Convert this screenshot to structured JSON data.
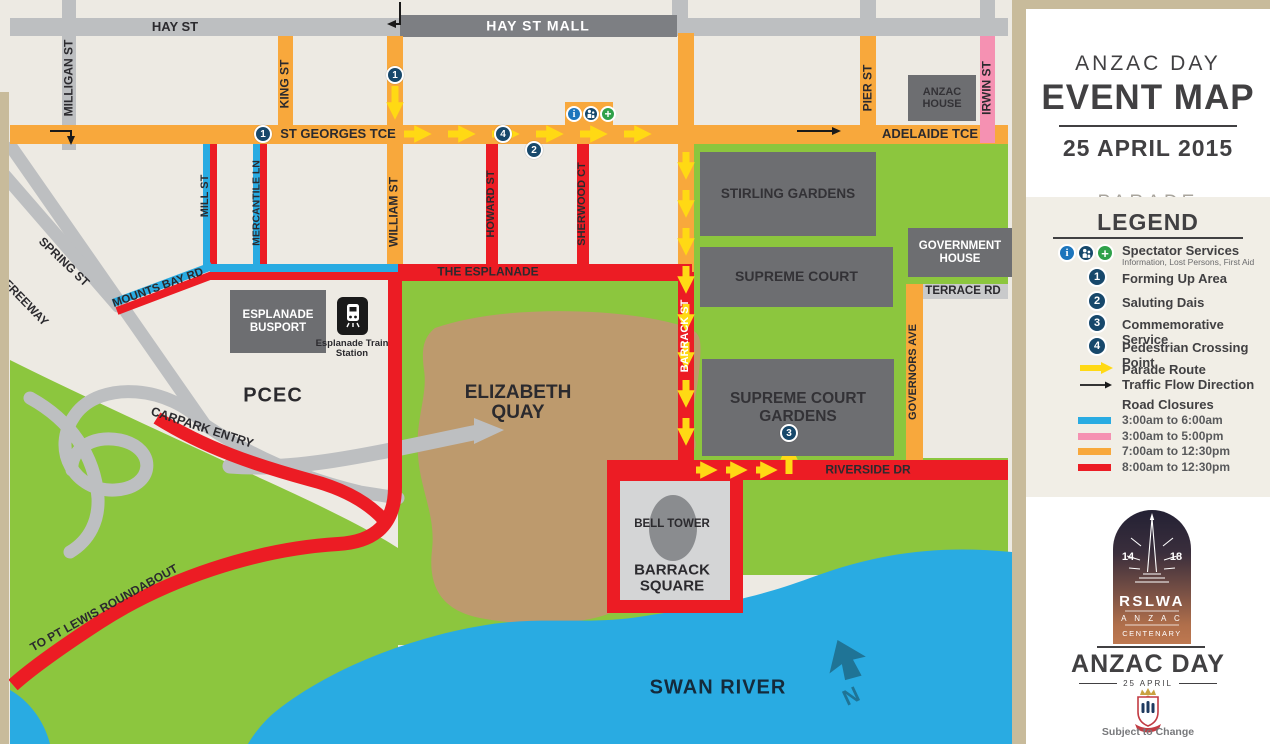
{
  "sidebar": {
    "title_line1": "ANZAC DAY",
    "title_line2": "EVENT MAP",
    "date": "25 APRIL 2015",
    "event": "PARADE",
    "start_time": "Start time: 9:30am",
    "location": "PERTH CBD",
    "legend": {
      "title": "LEGEND",
      "spectator_label": "Spectator Services",
      "spectator_sub": "Information, Lost Persons, First Aid",
      "numbered": [
        {
          "num": "1",
          "label": "Forming Up Area"
        },
        {
          "num": "2",
          "label": "Saluting Dais"
        },
        {
          "num": "3",
          "label": "Commemorative Service"
        },
        {
          "num": "4",
          "label": "Pedestrian Crossing Point"
        }
      ],
      "parade_route": "Parade Route",
      "traffic_flow": "Traffic Flow Direction",
      "road_closures_title": "Road Closures",
      "closures": [
        {
          "color": "#29ABE2",
          "label": "3:00am to 6:00am"
        },
        {
          "color": "#F591B2",
          "label": "3:00am to 5:00pm"
        },
        {
          "color": "#F8A83C",
          "label": "7:00am to 12:30pm"
        },
        {
          "color": "#EC1C24",
          "label": "8:00am to 12:30pm"
        }
      ]
    },
    "logo": {
      "year_left": "14",
      "year_right": "18",
      "org": "RSLWA",
      "line2": "A N Z A C",
      "line3": "CENTENARY"
    },
    "footer": {
      "title": "ANZAC DAY",
      "subtitle": "25 APRIL",
      "note": "Subject to Change"
    }
  },
  "map": {
    "colors": {
      "closure_blue": "#29ABE2",
      "closure_pink": "#F591B2",
      "closure_orange": "#F8A83C",
      "closure_red": "#EC1C24",
      "parade_yellow": "#FFD914",
      "parkland_green": "#8CC63E",
      "water_blue": "#29ABE2",
      "marker_navy": "#17486B"
    },
    "labels": {
      "hay_st": "HAY ST",
      "hay_st_mall": "HAY ST MALL",
      "milligan_st": "MILLIGAN ST",
      "king_st": "KING ST",
      "william_st": "WILLIAM ST",
      "st_georges_tce": "ST GEORGES TCE",
      "adelaide_tce": "ADELAIDE TCE",
      "pier_st": "PIER ST",
      "irwin_st": "IRWIN ST",
      "anzac_house": "ANZAC HOUSE",
      "mill_st": "MILL ST",
      "mercantile_ln": "MERCANTILE LN",
      "howard_st": "HOWARD ST",
      "sherwood_ct": "SHERWOOD CT",
      "barrack_st": "BARRACK ST",
      "the_esplanade": "THE ESPLANADE",
      "mounts_bay_rd": "MOUNTS BAY RD",
      "spring_st": "SPRING ST",
      "freeway": "FREEWAY",
      "carpark_entry": "CARPARK ENTRY",
      "to_pt_lewis": "TO PT LEWIS ROUNDABOUT",
      "pcec": "PCEC",
      "esplanade_busport": "ESPLANADE BUSPORT",
      "esplanade_train_station": "Esplanade Train Station",
      "elizabeth_quay": "ELIZABETH QUAY",
      "stirling_gardens": "STIRLING GARDENS",
      "supreme_court": "SUPREME COURT",
      "government_house": "GOVERNMENT HOUSE",
      "supreme_court_gardens": "SUPREME COURT GARDENS",
      "terrace_rd": "TERRACE RD",
      "governors_ave": "GOVERNORS AVE",
      "riverside_dr": "RIVERSIDE DR",
      "bell_tower": "BELL TOWER",
      "barrack_square": "BARRACK SQUARE",
      "swan_river": "SWAN RIVER",
      "north": "N"
    },
    "markers": {
      "forming_up": "1",
      "saluting_dais": "2",
      "commemorative_service": "3",
      "pedestrian_crossing": "4"
    },
    "icons": {
      "information": "i",
      "first_aid": "+"
    }
  }
}
